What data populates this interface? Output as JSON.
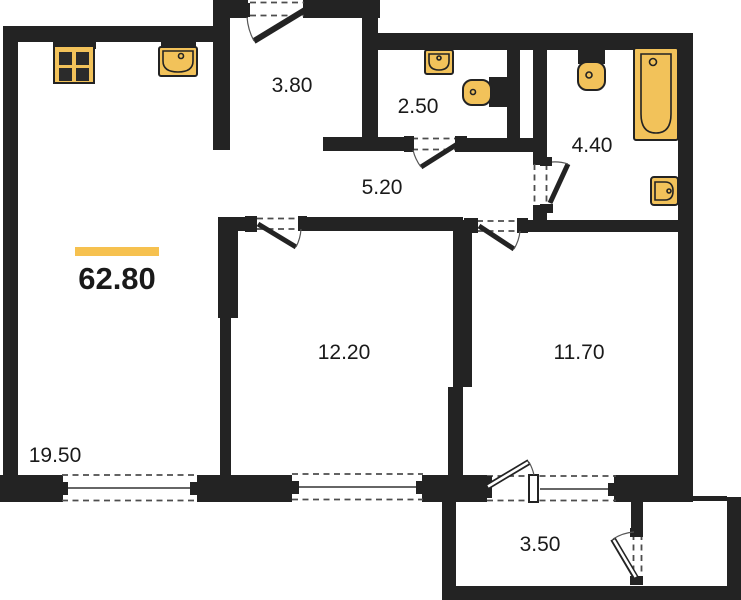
{
  "title": "Apartment floor plan",
  "colors": {
    "wall": "#232323",
    "fixture_fill": "#F2C25A",
    "accent_bar": "#F6C14F",
    "text": "#1A1A1A",
    "background": "#FFFFFF"
  },
  "total_area": {
    "value": "62.80"
  },
  "rooms": {
    "entrance_hall": {
      "area": "3.80"
    },
    "wc": {
      "area": "2.50"
    },
    "bathroom": {
      "area": "4.40"
    },
    "corridor": {
      "area": "5.20"
    },
    "living_kitchen": {
      "area": "19.50"
    },
    "bedroom_1": {
      "area": "12.20"
    },
    "bedroom_2": {
      "area": "11.70"
    },
    "balcony": {
      "area": "3.50"
    }
  },
  "fixtures": [
    "stove-icon",
    "kitchen-sink-icon",
    "wc-sink-icon",
    "wc-toilet-icon",
    "bathroom-toilet-icon",
    "bathtub-icon",
    "bathroom-sink-icon"
  ]
}
